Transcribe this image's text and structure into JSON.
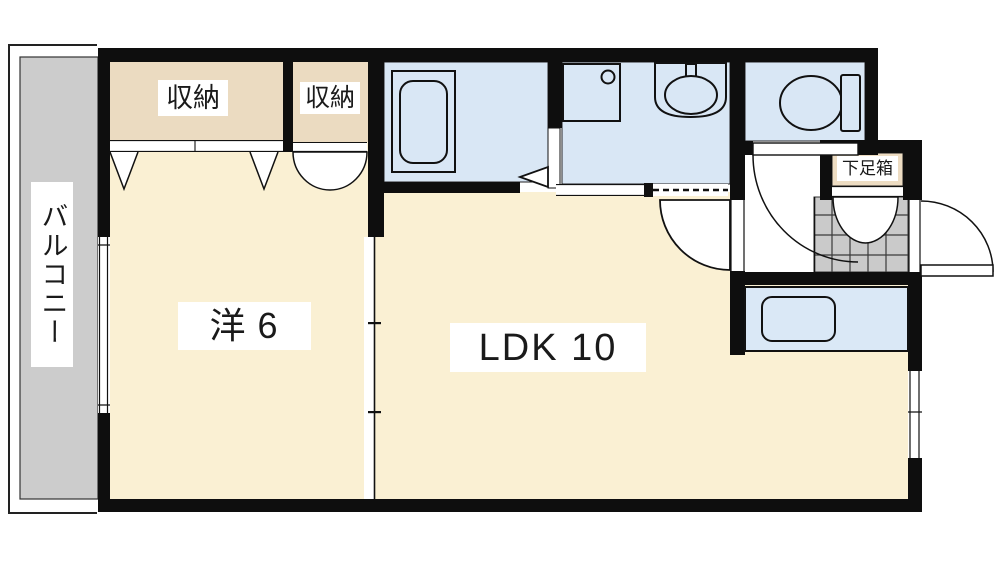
{
  "floorplan": {
    "type": "apartment-floor-plan",
    "rooms": {
      "balcony": {
        "label": "バルコニー"
      },
      "closet_left": {
        "label": "収納"
      },
      "closet_right": {
        "label": "収納"
      },
      "western_room": {
        "label": "洋6"
      },
      "ldk": {
        "label": "LDK 10"
      },
      "shoe_box": {
        "label": "下足箱"
      }
    },
    "colors": {
      "wall": "#0e0e0e",
      "floor": "#FAF0D3",
      "closet": "#EBDBC1",
      "wet_area": "#D9E7F5",
      "fixture": "#D9E7F5",
      "kitchen": "#DAE8F6",
      "balcony": "#CCCCCC",
      "tile": "#CACACA",
      "shoe_box": "#EDDCC2",
      "label_bg": "#FFFFFF",
      "line": "#141414",
      "text": "#1A1A1A"
    }
  }
}
